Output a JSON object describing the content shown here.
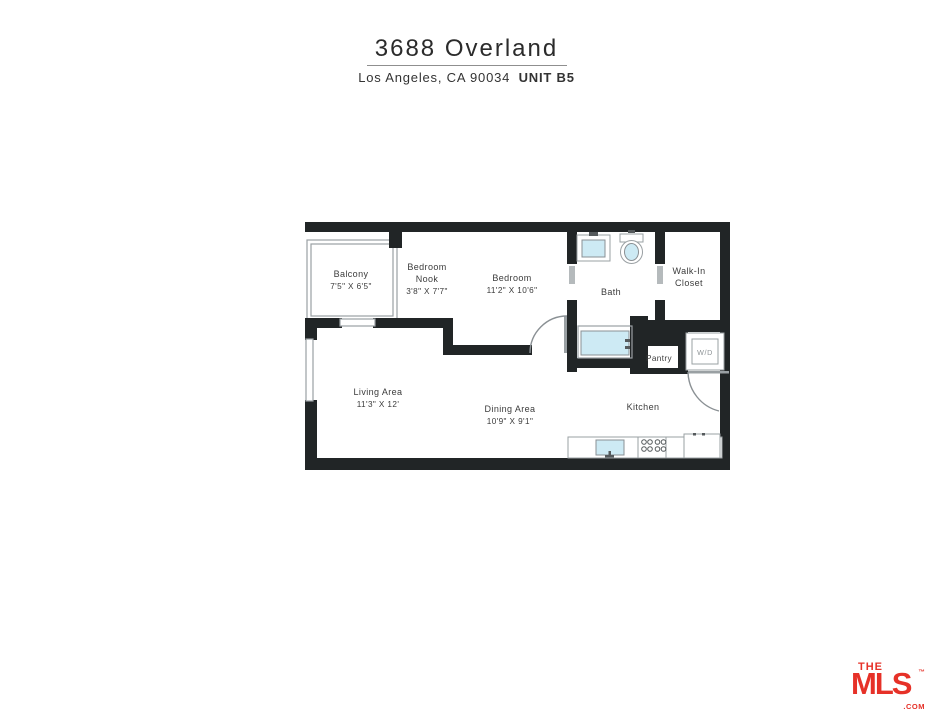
{
  "header": {
    "title": "3688 Overland",
    "subtitle_location": "Los Angeles, CA 90034",
    "subtitle_unit": "UNIT B5"
  },
  "floorplan": {
    "rooms": {
      "balcony": {
        "name": "Balcony",
        "dims": "7'5\" X 6'5\""
      },
      "bedroom_nook": {
        "line1": "Bedroom",
        "line2": "Nook",
        "dims": "3'8\" X 7'7\""
      },
      "bedroom": {
        "name": "Bedroom",
        "dims": "11'2\" X 10'6\""
      },
      "bath": {
        "name": "Bath"
      },
      "walk_in_closet": {
        "line1": "Walk-In",
        "line2": "Closet"
      },
      "living_area": {
        "name": "Living Area",
        "dims": "11'3\" X 12'"
      },
      "dining_area": {
        "name": "Dining Area",
        "dims": "10'9\" X 9'1\""
      },
      "kitchen": {
        "name": "Kitchen"
      },
      "pantry": {
        "name": "Pantry"
      },
      "washer_dryer": {
        "label": "W/D"
      }
    }
  },
  "branding": {
    "the": "THE",
    "mls": "MLS",
    "tm": "™",
    "com": ".COM"
  },
  "colors": {
    "wall": "#212526",
    "fixture_blue": "#cdeaf4",
    "accent_red": "#e63128"
  }
}
